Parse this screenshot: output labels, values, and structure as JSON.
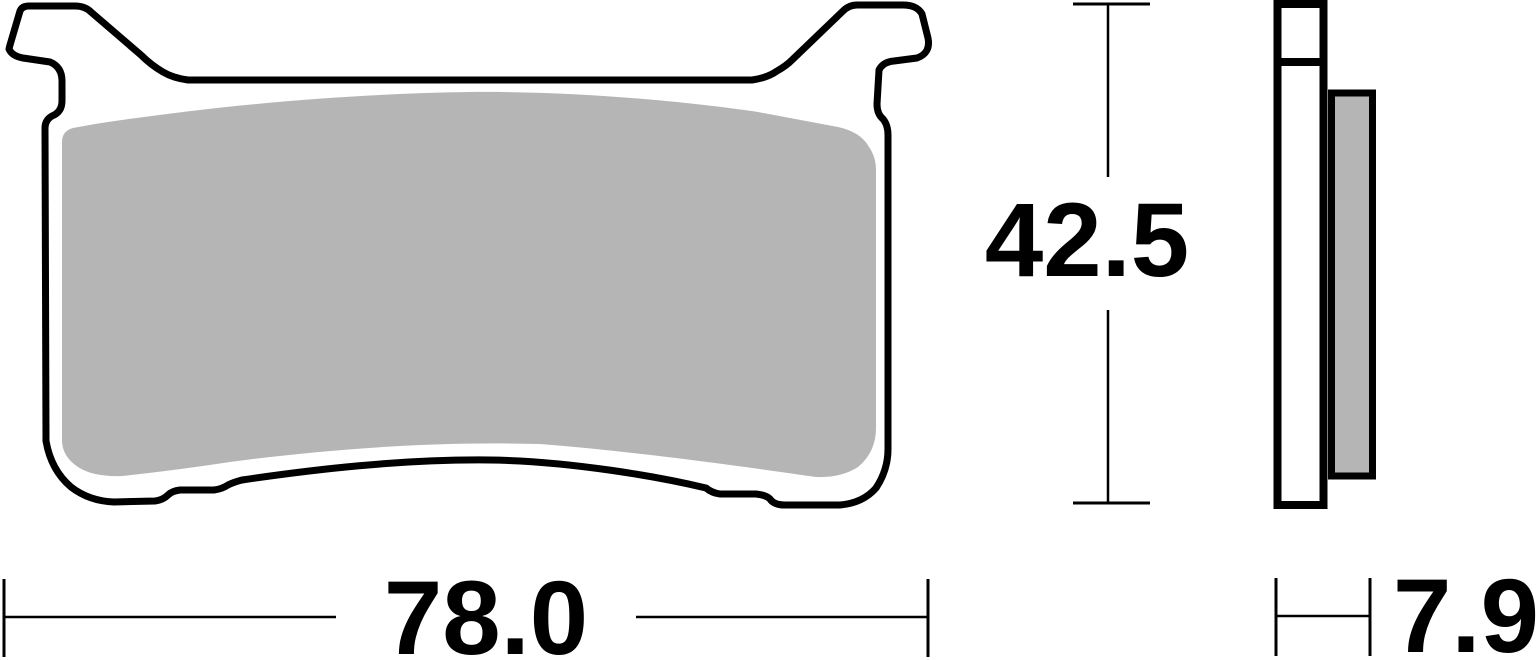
{
  "page": {
    "background": "#ffffff"
  },
  "drawing": {
    "outline_color": "#000000",
    "friction_color": "#b5b5b5",
    "dimension_labels": {
      "width": "78.0",
      "height": "42.5",
      "thickness": "7.9"
    }
  }
}
